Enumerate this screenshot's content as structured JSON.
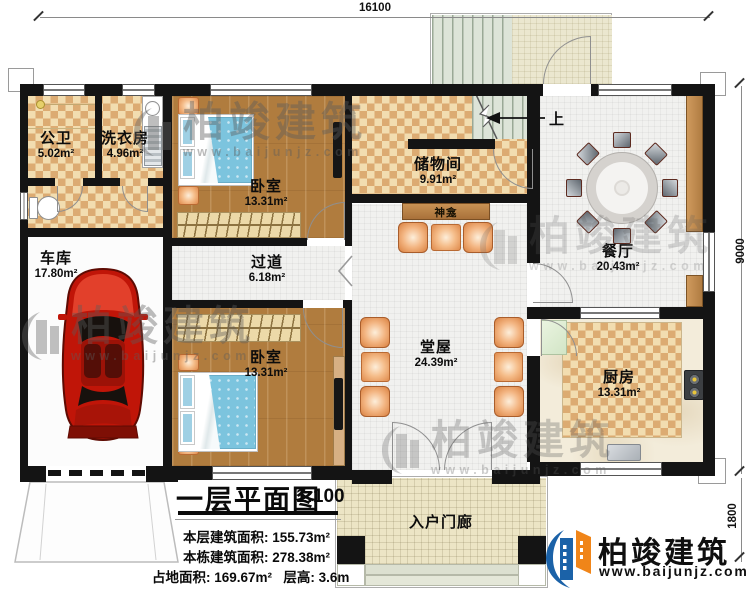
{
  "dimensions": {
    "top_width": "16100",
    "right_height": "9000",
    "porch_depth": "1800"
  },
  "stairs": {
    "direction_label": "上"
  },
  "rooms": [
    {
      "name": "公卫",
      "area": "5.02m²"
    },
    {
      "name": "洗衣房",
      "area": "4.96m²"
    },
    {
      "name": "卧室",
      "area": "13.31m²"
    },
    {
      "name": "储物间",
      "area": "9.91m²"
    },
    {
      "name": "神龛",
      "area": ""
    },
    {
      "name": "餐厅",
      "area": "20.43m²"
    },
    {
      "name": "车库",
      "area": "17.80m²"
    },
    {
      "name": "过道",
      "area": "6.18m²"
    },
    {
      "name": "卧室",
      "area": "13.31m²"
    },
    {
      "name": "堂屋",
      "area": "24.39m²"
    },
    {
      "name": "厨房",
      "area": "13.31m²"
    },
    {
      "name": "入户门廊",
      "area": ""
    }
  ],
  "title_block": {
    "title": "一层平面图",
    "scale": "1:100",
    "stats": [
      {
        "label": "本层建筑面积:",
        "value": "155.73m²"
      },
      {
        "label": "本栋建筑面积:",
        "value": "278.38m²"
      },
      {
        "label": "占地面积:",
        "value": "169.67m²"
      },
      {
        "label": "层高:",
        "value": "3.6m"
      }
    ]
  },
  "branding": {
    "company": "柏竣建筑",
    "website": "www.baijunjz.com"
  },
  "watermark": {
    "text": "柏竣建筑",
    "subtext": "www.baijunjz.com"
  }
}
